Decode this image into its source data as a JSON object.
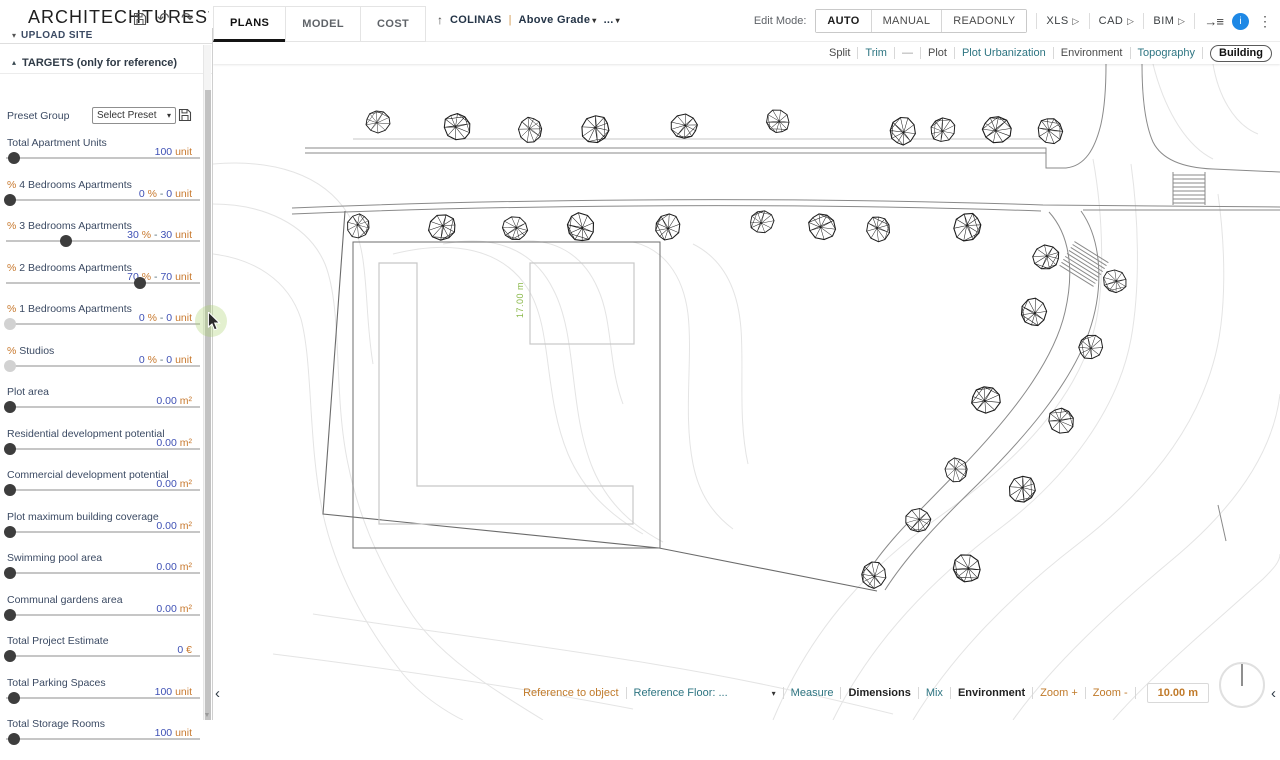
{
  "header": {
    "logo": "ARCHITECHTURES",
    "logo_mark": "'",
    "tabs": [
      {
        "label": "PLANS",
        "active": true
      },
      {
        "label": "MODEL",
        "active": false
      },
      {
        "label": "COST",
        "active": false
      }
    ],
    "project": {
      "up_arrow": "↑",
      "name": "COLINAS",
      "separator": "|",
      "level": "Above Grade",
      "more": "..."
    },
    "edit_mode": {
      "label": "Edit Mode:",
      "options": [
        {
          "label": "AUTO",
          "active": true
        },
        {
          "label": "MANUAL",
          "active": false
        },
        {
          "label": "READONLY",
          "active": false
        }
      ]
    },
    "exports": [
      {
        "label": "XLS"
      },
      {
        "label": "CAD"
      },
      {
        "label": "BIM"
      }
    ],
    "avatar_letter": "i",
    "kebab": "⋮",
    "panel_icon": "→≡"
  },
  "layers_toolbar": {
    "items": [
      {
        "label": "Split",
        "style": "dark"
      },
      {
        "label": "Trim",
        "style": "teal"
      },
      {
        "label": "—",
        "style": "muted"
      },
      {
        "label": "Plot",
        "style": "dark"
      },
      {
        "label": "Plot Urbanization",
        "style": "teal"
      },
      {
        "label": "Environment",
        "style": "dark"
      },
      {
        "label": "Topography",
        "style": "teal"
      },
      {
        "label": "Building",
        "style": "selected"
      }
    ]
  },
  "sidebar": {
    "upload_site": "UPLOAD SITE",
    "targets_header": "TARGETS (only for reference)",
    "preset": {
      "label": "Preset Group",
      "select_value": "Select Preset"
    },
    "sliders": [
      {
        "label": "Total Apartment Units",
        "value": [
          [
            "100",
            "n"
          ],
          [
            "unit",
            "u"
          ]
        ],
        "pos": 4,
        "disabled": false
      },
      {
        "label": "% 4 Bedrooms Apartments",
        "value": [
          [
            "0",
            "n"
          ],
          [
            "%",
            "u"
          ],
          [
            "-",
            "s"
          ],
          [
            "0",
            "n"
          ],
          [
            "unit",
            "u"
          ]
        ],
        "pos": 2,
        "disabled": false
      },
      {
        "label": "% 3 Bedrooms Apartments",
        "value": [
          [
            "30",
            "n"
          ],
          [
            "%",
            "u"
          ],
          [
            "-",
            "s"
          ],
          [
            "30",
            "n"
          ],
          [
            "unit",
            "u"
          ]
        ],
        "pos": 31,
        "disabled": false
      },
      {
        "label": "% 2 Bedrooms Apartments",
        "value": [
          [
            "70",
            "n"
          ],
          [
            "%",
            "u"
          ],
          [
            "-",
            "s"
          ],
          [
            "70",
            "n"
          ],
          [
            "unit",
            "u"
          ]
        ],
        "pos": 69,
        "disabled": false
      },
      {
        "label": "% 1 Bedrooms Apartments",
        "value": [
          [
            "0",
            "n"
          ],
          [
            "%",
            "u"
          ],
          [
            "-",
            "s"
          ],
          [
            "0",
            "n"
          ],
          [
            "unit",
            "u"
          ]
        ],
        "pos": 2,
        "disabled": true
      },
      {
        "label": "% Studios",
        "value": [
          [
            "0",
            "n"
          ],
          [
            "%",
            "u"
          ],
          [
            "-",
            "s"
          ],
          [
            "0",
            "n"
          ],
          [
            "unit",
            "u"
          ]
        ],
        "pos": 2,
        "disabled": true
      },
      {
        "label": "Plot area",
        "value": [
          [
            "0.00",
            "n"
          ],
          [
            "m²",
            "u"
          ]
        ],
        "pos": 2,
        "disabled": false
      },
      {
        "label": "Residential development potential",
        "value": [
          [
            "0.00",
            "n"
          ],
          [
            "m²",
            "u"
          ]
        ],
        "pos": 2,
        "disabled": false
      },
      {
        "label": "Commercial development potential",
        "value": [
          [
            "0.00",
            "n"
          ],
          [
            "m²",
            "u"
          ]
        ],
        "pos": 2,
        "disabled": false
      },
      {
        "label": "Plot maximum building coverage",
        "value": [
          [
            "0.00",
            "n"
          ],
          [
            "m²",
            "u"
          ]
        ],
        "pos": 2,
        "disabled": false
      },
      {
        "label": "Swimming pool area",
        "value": [
          [
            "0.00",
            "n"
          ],
          [
            "m²",
            "u"
          ]
        ],
        "pos": 2,
        "disabled": false
      },
      {
        "label": "Communal gardens area",
        "value": [
          [
            "0.00",
            "n"
          ],
          [
            "m²",
            "u"
          ]
        ],
        "pos": 2,
        "disabled": false
      },
      {
        "label": "Total Project Estimate",
        "value": [
          [
            "0",
            "n"
          ],
          [
            "€",
            "u"
          ]
        ],
        "pos": 2,
        "disabled": false
      },
      {
        "label": "Total Parking Spaces",
        "value": [
          [
            "100",
            "n"
          ],
          [
            "unit",
            "u"
          ]
        ],
        "pos": 4,
        "disabled": false
      },
      {
        "label": "Total Storage Rooms",
        "value": [
          [
            "100",
            "n"
          ],
          [
            "unit",
            "u"
          ]
        ],
        "pos": 4,
        "disabled": false
      }
    ]
  },
  "canvas": {
    "dimension_label": "17.00 m",
    "trees": [
      [
        165,
        58
      ],
      [
        244,
        63
      ],
      [
        317,
        66
      ],
      [
        382,
        65
      ],
      [
        471,
        62
      ],
      [
        565,
        57
      ],
      [
        690,
        67
      ],
      [
        730,
        66
      ],
      [
        784,
        66
      ],
      [
        837,
        67
      ],
      [
        145,
        162
      ],
      [
        229,
        163
      ],
      [
        302,
        164
      ],
      [
        368,
        163
      ],
      [
        455,
        163
      ],
      [
        549,
        158
      ],
      [
        609,
        163
      ],
      [
        665,
        165
      ],
      [
        754,
        163
      ],
      [
        833,
        193
      ],
      [
        902,
        217
      ],
      [
        821,
        248
      ],
      [
        878,
        283
      ],
      [
        773,
        336
      ],
      [
        848,
        357
      ],
      [
        743,
        406
      ],
      [
        809,
        425
      ],
      [
        705,
        456
      ],
      [
        754,
        504
      ],
      [
        661,
        511
      ]
    ]
  },
  "bottom_bar": {
    "items": [
      {
        "label": "Reference to object",
        "style": "orange"
      },
      {
        "label": "Reference Floor:  ...",
        "style": "teal",
        "caret": true,
        "wide": true
      },
      {
        "label": "Measure",
        "style": "teal"
      },
      {
        "label": "Dimensions",
        "style": "bold"
      },
      {
        "label": "Mix",
        "style": "teal"
      },
      {
        "label": "Environment",
        "style": "bold"
      },
      {
        "label": "Zoom +",
        "style": "orange"
      },
      {
        "label": "Zoom -",
        "style": "orange"
      }
    ],
    "scale_value": "10.00 m",
    "left_chevron": "‹",
    "right_chevron": "‹"
  },
  "colors": {
    "accent_orange": "#c8792e",
    "number_indigo": "#3f51b5",
    "link_teal": "#2e7582",
    "avatar_blue": "#1e88e5",
    "dimension_green": "#8ab84a"
  }
}
